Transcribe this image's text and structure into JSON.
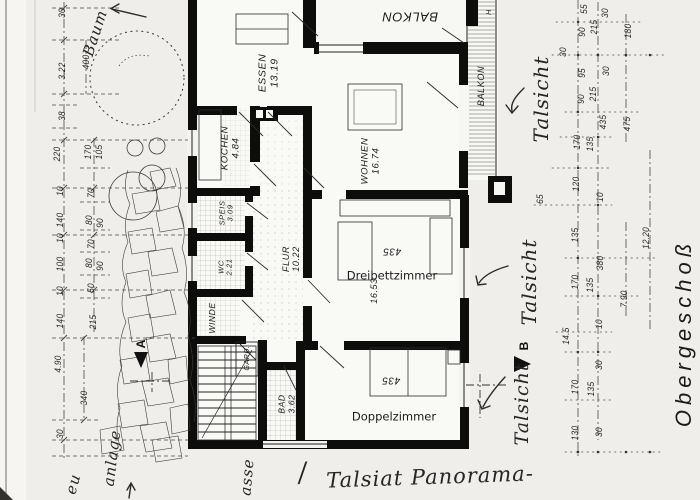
{
  "document": {
    "floor_title": "Obergeschoß",
    "colors": {
      "paper": "#efeeea",
      "ink": "#1c1c1c",
      "wall": "#0d0d0c"
    }
  },
  "room_labels": [
    {
      "name": "room-label-balkon-top",
      "text": "BALKON",
      "x": 410,
      "y": 16,
      "rot": 180,
      "size": 13
    },
    {
      "name": "room-label-essen",
      "text": "ESSEN",
      "sub": "13.19",
      "x": 269,
      "y": 73,
      "rot": -90,
      "size": 10.5
    },
    {
      "name": "room-label-kochen",
      "text": "KOCHEN",
      "sub": "4.84",
      "x": 231,
      "y": 148,
      "rot": -90,
      "size": 9.5
    },
    {
      "name": "room-label-wohnen",
      "text": "WOHNEN",
      "sub": "16.74",
      "x": 371,
      "y": 161,
      "rot": -90,
      "size": 9.5
    },
    {
      "name": "room-label-balkon-right",
      "text": "BALKON",
      "x": 481,
      "y": 86,
      "rot": -90,
      "size": 9
    },
    {
      "name": "room-label-speis",
      "text": "SPEIS",
      "sub": "3.09",
      "x": 227,
      "y": 213,
      "rot": -90,
      "size": 7.5
    },
    {
      "name": "room-label-wc",
      "text": "WC",
      "sub": "2.21",
      "x": 226,
      "y": 267,
      "rot": -90,
      "size": 7.5
    },
    {
      "name": "room-label-flur",
      "text": "FLUR",
      "sub": "10.22",
      "x": 291,
      "y": 259,
      "rot": -90,
      "size": 9
    },
    {
      "name": "room-label-winde",
      "text": "WINDE",
      "x": 213,
      "y": 318,
      "rot": -90,
      "size": 8.5
    },
    {
      "name": "room-label-gard",
      "text": "GARD.",
      "x": 248,
      "y": 358,
      "rot": -90,
      "size": 7
    },
    {
      "name": "room-label-bad",
      "text": "BAD",
      "sub": "3.62",
      "x": 287,
      "y": 404,
      "rot": -90,
      "size": 8.5
    },
    {
      "name": "room-label-dreibettzimmer",
      "text": "Dreibettzimmer",
      "x": 392,
      "y": 276,
      "rot": 0,
      "size": 11.5,
      "style": "digital"
    },
    {
      "name": "area-dreibettzimmer",
      "text": "435",
      "x": 392,
      "y": 251,
      "rot": 180,
      "size": 10
    },
    {
      "name": "size-dreibettzimmer",
      "text": "16.53",
      "x": 374,
      "y": 291,
      "rot": -90,
      "size": 9
    },
    {
      "name": "room-label-doppelzimmer",
      "text": "Doppelzimmer",
      "x": 394,
      "y": 417,
      "rot": 0,
      "size": 11.5,
      "style": "digital"
    },
    {
      "name": "area-doppelzimmer",
      "text": "435",
      "x": 391,
      "y": 380,
      "rot": 180,
      "size": 10
    },
    {
      "name": "mark-h",
      "text": "H",
      "x": 490,
      "y": 12,
      "rot": -90,
      "size": 7
    }
  ],
  "dimensions": [
    {
      "text": "30",
      "x": 62,
      "y": 13
    },
    {
      "text": "3.22",
      "x": 62,
      "y": 71
    },
    {
      "text": "400",
      "x": 86,
      "y": 62
    },
    {
      "text": "38",
      "x": 62,
      "y": 116
    },
    {
      "text": "220",
      "x": 57,
      "y": 154
    },
    {
      "text": "170",
      "x": 88,
      "y": 152
    },
    {
      "text": "105",
      "x": 99,
      "y": 152
    },
    {
      "text": "10",
      "x": 60,
      "y": 191
    },
    {
      "text": "70",
      "x": 91,
      "y": 193
    },
    {
      "text": "140",
      "x": 60,
      "y": 220
    },
    {
      "text": "80",
      "x": 89,
      "y": 220
    },
    {
      "text": "90",
      "x": 100,
      "y": 223
    },
    {
      "text": "10",
      "x": 60,
      "y": 238
    },
    {
      "text": "70",
      "x": 91,
      "y": 244
    },
    {
      "text": "100",
      "x": 60,
      "y": 264
    },
    {
      "text": "80",
      "x": 89,
      "y": 263
    },
    {
      "text": "90",
      "x": 100,
      "y": 266
    },
    {
      "text": "10",
      "x": 60,
      "y": 291
    },
    {
      "text": "50",
      "x": 91,
      "y": 288
    },
    {
      "text": "140",
      "x": 60,
      "y": 321
    },
    {
      "text": "215",
      "x": 93,
      "y": 322
    },
    {
      "text": "4.90",
      "x": 58,
      "y": 364
    },
    {
      "text": "340",
      "x": 84,
      "y": 398
    },
    {
      "text": "30",
      "x": 60,
      "y": 434
    },
    {
      "text": "55",
      "x": 584,
      "y": 9
    },
    {
      "text": "30",
      "x": 605,
      "y": 13
    },
    {
      "text": "90",
      "x": 582,
      "y": 32
    },
    {
      "text": "215",
      "x": 594,
      "y": 27
    },
    {
      "text": "180",
      "x": 628,
      "y": 31
    },
    {
      "text": "30",
      "x": 563,
      "y": 52
    },
    {
      "text": "95",
      "x": 582,
      "y": 73
    },
    {
      "text": "30",
      "x": 606,
      "y": 71
    },
    {
      "text": "90",
      "x": 581,
      "y": 99
    },
    {
      "text": "215",
      "x": 593,
      "y": 94
    },
    {
      "text": "435",
      "x": 603,
      "y": 122
    },
    {
      "text": "475",
      "x": 627,
      "y": 124
    },
    {
      "text": "170",
      "x": 577,
      "y": 142
    },
    {
      "text": "135",
      "x": 590,
      "y": 144
    },
    {
      "text": "65",
      "x": 540,
      "y": 199
    },
    {
      "text": "120",
      "x": 576,
      "y": 184
    },
    {
      "text": "10",
      "x": 600,
      "y": 197
    },
    {
      "text": "135",
      "x": 575,
      "y": 235
    },
    {
      "text": "12.20",
      "x": 646,
      "y": 238
    },
    {
      "text": "380",
      "x": 600,
      "y": 263
    },
    {
      "text": "170",
      "x": 575,
      "y": 282
    },
    {
      "text": "135",
      "x": 590,
      "y": 285
    },
    {
      "text": "7.90",
      "x": 624,
      "y": 299
    },
    {
      "text": "10",
      "x": 599,
      "y": 324
    },
    {
      "text": "14.5",
      "x": 566,
      "y": 336
    },
    {
      "text": "30",
      "x": 599,
      "y": 365
    },
    {
      "text": "170",
      "x": 575,
      "y": 387
    },
    {
      "text": "135",
      "x": 591,
      "y": 389
    },
    {
      "text": "130",
      "x": 575,
      "y": 433
    },
    {
      "text": "30",
      "x": 599,
      "y": 432
    }
  ],
  "handwriting": [
    {
      "name": "note-baum",
      "text": "Baum",
      "x": 95,
      "y": 33,
      "rot": -72,
      "size": 15
    },
    {
      "name": "note-talsicht-top",
      "text": "Talsicht",
      "x": 541,
      "y": 99,
      "rot": -90,
      "size": 20
    },
    {
      "name": "note-talsicht-mid",
      "text": "Talsicht",
      "x": 529,
      "y": 282,
      "rot": -90,
      "size": 20
    },
    {
      "name": "note-talsicht-bottom",
      "text": "Talsicht",
      "x": 522,
      "y": 404,
      "rot": -90,
      "size": 19
    },
    {
      "name": "note-slash",
      "text": "/",
      "x": 303,
      "y": 473,
      "rot": -8,
      "size": 26
    },
    {
      "name": "note-panorama",
      "text": "Talsiat Panorama-",
      "x": 430,
      "y": 477,
      "rot": -2,
      "size": 21
    },
    {
      "name": "note-asse",
      "text": "asse",
      "x": 247,
      "y": 477,
      "rot": -85,
      "size": 15
    },
    {
      "name": "note-anlage",
      "text": "anlage",
      "x": 112,
      "y": 458,
      "rot": -83,
      "size": 15
    },
    {
      "name": "note-eu",
      "text": "eu",
      "x": 73,
      "y": 484,
      "rot": -75,
      "size": 15
    }
  ],
  "markers": [
    {
      "name": "section-marker-a",
      "text": "A",
      "x": 141,
      "y": 344,
      "rot": -90
    },
    {
      "name": "section-marker-b",
      "text": "B",
      "x": 524,
      "y": 346,
      "rot": -90
    }
  ]
}
